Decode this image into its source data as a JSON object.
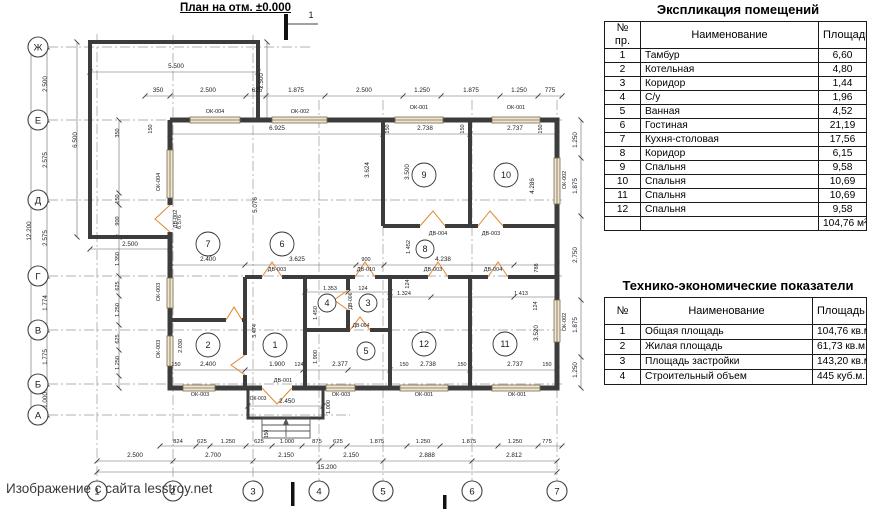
{
  "title": "План на отм. ±0.000",
  "watermark": "Изображение с сайта lesstroy.net",
  "explication": {
    "title": "Экспликация помещений",
    "headers": [
      "№ пр.",
      "Наименование",
      "Площадь"
    ],
    "rows": [
      [
        "1",
        "Тамбур",
        "6,60"
      ],
      [
        "2",
        "Котельная",
        "4,80"
      ],
      [
        "3",
        "Коридор",
        "1,44"
      ],
      [
        "4",
        "С/у",
        "1,96"
      ],
      [
        "5",
        "Ванная",
        "4,52"
      ],
      [
        "6",
        "Гостиная",
        "21,19"
      ],
      [
        "7",
        "Кухня-столовая",
        "17,56"
      ],
      [
        "8",
        "Коридор",
        "6,15"
      ],
      [
        "9",
        "Спальня",
        "9,58"
      ],
      [
        "10",
        "Спальня",
        "10,69"
      ],
      [
        "11",
        "Спальня",
        "10,69"
      ],
      [
        "12",
        "Спальня",
        "9,58"
      ]
    ],
    "total": "104,76 м²"
  },
  "tech": {
    "title": "Технико-экономические показатели",
    "headers": [
      "№",
      "Наименование",
      "Площадь"
    ],
    "rows": [
      [
        "1",
        "Общая площадь",
        "104,76 кв.м."
      ],
      [
        "2",
        "Жилая площадь",
        "61,73 кв.м."
      ],
      [
        "3",
        "Площадь застройки",
        "143,20 кв.м"
      ],
      [
        "4",
        "Строительный объем",
        "445 куб.м."
      ]
    ]
  },
  "plan": {
    "section_mark": "1",
    "axes_letters": [
      {
        "l": "Ж",
        "y": 47
      },
      {
        "l": "Е",
        "y": 120
      },
      {
        "l": "Д",
        "y": 200
      },
      {
        "l": "Г",
        "y": 276
      },
      {
        "l": "В",
        "y": 330
      },
      {
        "l": "Б",
        "y": 384
      },
      {
        "l": "А",
        "y": 415
      }
    ],
    "axes_numbers": [
      {
        "l": "1",
        "x": 97
      },
      {
        "l": "2",
        "x": 173
      },
      {
        "l": "3",
        "x": 253
      },
      {
        "l": "4",
        "x": 319
      },
      {
        "l": "5",
        "x": 383
      },
      {
        "l": "6",
        "x": 472
      },
      {
        "l": "7",
        "x": 557
      }
    ],
    "rooms": [
      {
        "n": "1",
        "x": 275,
        "y": 345,
        "r": 12
      },
      {
        "n": "2",
        "x": 208,
        "y": 345,
        "r": 12
      },
      {
        "n": "3",
        "x": 368,
        "y": 303,
        "r": 9
      },
      {
        "n": "4",
        "x": 327,
        "y": 303,
        "r": 9
      },
      {
        "n": "5",
        "x": 366,
        "y": 351,
        "r": 9
      },
      {
        "n": "6",
        "x": 282,
        "y": 244,
        "r": 12
      },
      {
        "n": "7",
        "x": 208,
        "y": 244,
        "r": 12
      },
      {
        "n": "8",
        "x": 425,
        "y": 249,
        "r": 9
      },
      {
        "n": "9",
        "x": 424,
        "y": 175,
        "r": 12
      },
      {
        "n": "10",
        "x": 506,
        "y": 175,
        "r": 12
      },
      {
        "n": "11",
        "x": 505,
        "y": 344,
        "r": 12
      },
      {
        "n": "12",
        "x": 424,
        "y": 344,
        "r": 12
      }
    ],
    "labels": [
      {
        "t": "5.500",
        "x": 176,
        "y": 68
      },
      {
        "t": "350",
        "x": 158,
        "y": 92
      },
      {
        "t": "2.500",
        "x": 208,
        "y": 92
      },
      {
        "t": "625",
        "x": 257,
        "y": 92
      },
      {
        "t": "1.875",
        "x": 296,
        "y": 92
      },
      {
        "t": "2.500",
        "x": 364,
        "y": 92
      },
      {
        "t": "1.250",
        "x": 422,
        "y": 92
      },
      {
        "t": "1.875",
        "x": 471,
        "y": 92
      },
      {
        "t": "1.250",
        "x": 519,
        "y": 92
      },
      {
        "t": "775",
        "x": 550,
        "y": 92
      },
      {
        "t": "ОК-004",
        "x": 215,
        "y": 113,
        "s": 5.5
      },
      {
        "t": "ОК-002",
        "x": 300,
        "y": 113,
        "s": 5.5
      },
      {
        "t": "ОК-001",
        "x": 419,
        "y": 109,
        "s": 5.5
      },
      {
        "t": "ОК-001",
        "x": 516,
        "y": 109,
        "s": 5.5
      },
      {
        "t": "1",
        "x": 311,
        "y": 18,
        "s": 9
      },
      {
        "t": "2.500",
        "x": 47,
        "y": 84,
        "r": -90
      },
      {
        "t": "2.575",
        "x": 47,
        "y": 160,
        "r": -90
      },
      {
        "t": "2.575",
        "x": 47,
        "y": 238,
        "r": -90
      },
      {
        "t": "1.774",
        "x": 47,
        "y": 303,
        "r": -90
      },
      {
        "t": "1.775",
        "x": 47,
        "y": 357,
        "r": -90
      },
      {
        "t": "1.000",
        "x": 47,
        "y": 400,
        "r": -90
      },
      {
        "t": "12.200",
        "x": 31,
        "y": 231,
        "r": -90
      },
      {
        "t": "6.500",
        "x": 77,
        "y": 140,
        "r": -90
      },
      {
        "t": "2.500",
        "x": 263,
        "y": 81,
        "r": -90
      },
      {
        "t": "350",
        "x": 119,
        "y": 133,
        "r": -90,
        "s": 5.5
      },
      {
        "t": "150",
        "x": 119,
        "y": 199,
        "r": -90,
        "s": 5.5
      },
      {
        "t": "900",
        "x": 119,
        "y": 221,
        "r": -90,
        "s": 5.5
      },
      {
        "t": "1.350",
        "x": 119,
        "y": 259,
        "r": -90,
        "s": 5.5
      },
      {
        "t": "625",
        "x": 119,
        "y": 286,
        "r": -90,
        "s": 5.5
      },
      {
        "t": "1.250",
        "x": 119,
        "y": 310,
        "r": -90,
        "s": 5.5
      },
      {
        "t": "625",
        "x": 119,
        "y": 339,
        "r": -90,
        "s": 5.5
      },
      {
        "t": "1.250",
        "x": 119,
        "y": 363,
        "r": -90,
        "s": 5.5
      },
      {
        "t": "2.500",
        "x": 130,
        "y": 246
      },
      {
        "t": "ОК-004",
        "x": 160,
        "y": 182,
        "r": -90,
        "s": 5.5
      },
      {
        "t": "ДВ-002",
        "x": 177,
        "y": 219,
        "r": -90,
        "s": 5.5
      },
      {
        "t": "ОК-003",
        "x": 160,
        "y": 292,
        "r": -90,
        "s": 5.5
      },
      {
        "t": "ОК-003",
        "x": 160,
        "y": 349,
        "r": -90,
        "s": 5.5
      },
      {
        "t": "6.576",
        "x": 181,
        "y": 222,
        "r": -90,
        "s": 5.5
      },
      {
        "t": "6.925",
        "x": 277,
        "y": 130
      },
      {
        "t": "150",
        "x": 152,
        "y": 129,
        "r": -90,
        "s": 5.5
      },
      {
        "t": "2.738",
        "x": 425,
        "y": 130
      },
      {
        "t": "150",
        "x": 389,
        "y": 129,
        "r": -90,
        "s": 5.5
      },
      {
        "t": "150",
        "x": 464,
        "y": 129,
        "r": -90,
        "s": 5.5
      },
      {
        "t": "2.737",
        "x": 515,
        "y": 130
      },
      {
        "t": "150",
        "x": 542,
        "y": 129,
        "r": -90,
        "s": 5.5
      },
      {
        "t": "3.624",
        "x": 369,
        "y": 170,
        "r": -90
      },
      {
        "t": "3.500",
        "x": 409,
        "y": 172,
        "r": -90
      },
      {
        "t": "4.286",
        "x": 534,
        "y": 186,
        "r": -90
      },
      {
        "t": "5.076",
        "x": 257,
        "y": 205,
        "r": -90
      },
      {
        "t": "ДВ-004",
        "x": 438,
        "y": 235,
        "s": 5.5
      },
      {
        "t": "ДВ-003",
        "x": 491,
        "y": 235,
        "s": 5.5
      },
      {
        "t": "1.452",
        "x": 410,
        "y": 247,
        "r": -90,
        "s": 5.5
      },
      {
        "t": "124",
        "x": 409,
        "y": 284,
        "r": -90,
        "s": 5.5
      },
      {
        "t": "2.400",
        "x": 208,
        "y": 261
      },
      {
        "t": "3.625",
        "x": 297,
        "y": 261
      },
      {
        "t": "900",
        "x": 366,
        "y": 261,
        "s": 5.5
      },
      {
        "t": "4.238",
        "x": 443,
        "y": 261
      },
      {
        "t": "788",
        "x": 538,
        "y": 268,
        "r": -90,
        "s": 5.5
      },
      {
        "t": "ДВ-003",
        "x": 277,
        "y": 271,
        "s": 5.5
      },
      {
        "t": "ДВ-010",
        "x": 366,
        "y": 271,
        "s": 5.5
      },
      {
        "t": "ДВ-003",
        "x": 433,
        "y": 271,
        "s": 5.5
      },
      {
        "t": "ДВ-004",
        "x": 493,
        "y": 271,
        "s": 5.5
      },
      {
        "t": "1.353",
        "x": 330,
        "y": 290,
        "s": 5.5
      },
      {
        "t": "124",
        "x": 363,
        "y": 290,
        "s": 5.5
      },
      {
        "t": "1.324",
        "x": 404,
        "y": 295,
        "s": 5.5
      },
      {
        "t": "1.413",
        "x": 521,
        "y": 295,
        "s": 5.5
      },
      {
        "t": "ДВ-006",
        "x": 352,
        "y": 301,
        "r": -90,
        "s": 5
      },
      {
        "t": "1.450",
        "x": 317,
        "y": 313,
        "r": -90,
        "s": 5.5
      },
      {
        "t": "124",
        "x": 537,
        "y": 306,
        "r": -90,
        "s": 5.5
      },
      {
        "t": "3.520",
        "x": 538,
        "y": 333,
        "r": -90
      },
      {
        "t": "ДВ-004",
        "x": 361,
        "y": 327,
        "s": 5
      },
      {
        "t": "1.900",
        "x": 317,
        "y": 357,
        "r": -90,
        "s": 5.5
      },
      {
        "t": "2.030",
        "x": 182,
        "y": 346,
        "r": -90,
        "s": 5.5
      },
      {
        "t": "3.474",
        "x": 256,
        "y": 331,
        "r": -90,
        "s": 5.5
      },
      {
        "t": "150",
        "x": 176,
        "y": 366,
        "s": 5.5
      },
      {
        "t": "2.400",
        "x": 208,
        "y": 366
      },
      {
        "t": "1.900",
        "x": 277,
        "y": 366
      },
      {
        "t": "124",
        "x": 299,
        "y": 366,
        "s": 5.5
      },
      {
        "t": "2.377",
        "x": 340,
        "y": 366
      },
      {
        "t": "150",
        "x": 404,
        "y": 366,
        "s": 5.5
      },
      {
        "t": "2.738",
        "x": 428,
        "y": 366
      },
      {
        "t": "150",
        "x": 462,
        "y": 366,
        "s": 5.5
      },
      {
        "t": "2.737",
        "x": 515,
        "y": 366
      },
      {
        "t": "150",
        "x": 547,
        "y": 366,
        "s": 5.5
      },
      {
        "t": "ОК-003",
        "x": 200,
        "y": 396,
        "s": 5.5
      },
      {
        "t": "ОК-003",
        "x": 341,
        "y": 396,
        "s": 5.5
      },
      {
        "t": "ОК-001",
        "x": 424,
        "y": 396,
        "s": 5.5
      },
      {
        "t": "ОК-001",
        "x": 517,
        "y": 396,
        "s": 5.5
      },
      {
        "t": "ДВ-001",
        "x": 283,
        "y": 382,
        "s": 5.5
      },
      {
        "t": "ОК-003",
        "x": 258,
        "y": 400,
        "s": 5
      },
      {
        "t": "2.450",
        "x": 287,
        "y": 403
      },
      {
        "t": "1.000",
        "x": 330,
        "y": 407,
        "r": -90,
        "s": 5.5
      },
      {
        "t": "150",
        "x": 268,
        "y": 434,
        "r": -90,
        "s": 5
      },
      {
        "t": "824",
        "x": 178,
        "y": 443,
        "s": 5.8
      },
      {
        "t": "625",
        "x": 202,
        "y": 443,
        "s": 5.8
      },
      {
        "t": "1.250",
        "x": 228,
        "y": 443,
        "s": 5.8
      },
      {
        "t": "625",
        "x": 259,
        "y": 443,
        "s": 5.8
      },
      {
        "t": "1.000",
        "x": 287,
        "y": 443,
        "s": 5.8
      },
      {
        "t": "875",
        "x": 317,
        "y": 443,
        "s": 5.8
      },
      {
        "t": "625",
        "x": 338,
        "y": 443,
        "s": 5.8
      },
      {
        "t": "1.875",
        "x": 377,
        "y": 443,
        "s": 5.8
      },
      {
        "t": "1.250",
        "x": 423,
        "y": 443,
        "s": 5.8
      },
      {
        "t": "1.875",
        "x": 469,
        "y": 443,
        "s": 5.8
      },
      {
        "t": "1.250",
        "x": 515,
        "y": 443,
        "s": 5.8
      },
      {
        "t": "775",
        "x": 547,
        "y": 443,
        "s": 5.8
      },
      {
        "t": "2.500",
        "x": 135,
        "y": 457
      },
      {
        "t": "2.700",
        "x": 213,
        "y": 457
      },
      {
        "t": "2.150",
        "x": 286,
        "y": 457
      },
      {
        "t": "2.150",
        "x": 351,
        "y": 457
      },
      {
        "t": "2.888",
        "x": 427,
        "y": 457
      },
      {
        "t": "2.812",
        "x": 514,
        "y": 457
      },
      {
        "t": "15.200",
        "x": 327,
        "y": 469
      },
      {
        "t": "1.250",
        "x": 577,
        "y": 140,
        "r": -90
      },
      {
        "t": "1.875",
        "x": 577,
        "y": 186,
        "r": -90
      },
      {
        "t": "2.750",
        "x": 577,
        "y": 255,
        "r": -90
      },
      {
        "t": "1.875",
        "x": 577,
        "y": 325,
        "r": -90
      },
      {
        "t": "1.250",
        "x": 577,
        "y": 370,
        "r": -90
      },
      {
        "t": "ОК-002",
        "x": 566,
        "y": 180,
        "r": -90,
        "s": 5.5
      },
      {
        "t": "ОК-002",
        "x": 566,
        "y": 322,
        "r": -90,
        "s": 5.5
      }
    ],
    "chains": [
      {
        "o": "h",
        "p": 96,
        "a": 145,
        "b": 562,
        "t": [
          145,
          170,
          246,
          266,
          325,
          403,
          441,
          500,
          538,
          562
        ]
      },
      {
        "o": "h",
        "p": 72,
        "a": 90,
        "b": 258,
        "t": [
          90,
          258
        ]
      },
      {
        "o": "v",
        "p": 47,
        "a": 47,
        "b": 415,
        "t": [
          47,
          120,
          200,
          276,
          330,
          384,
          415
        ]
      },
      {
        "o": "v",
        "p": 31,
        "a": 47,
        "b": 415,
        "t": [
          47,
          415
        ]
      },
      {
        "o": "v",
        "p": 119,
        "a": 120,
        "b": 388,
        "t": [
          120,
          193,
          205,
          237,
          276,
          296,
          325,
          350,
          376,
          388
        ]
      },
      {
        "o": "v",
        "p": 77,
        "a": 42,
        "b": 237,
        "t": [
          42,
          237
        ]
      },
      {
        "o": "v",
        "p": 267,
        "a": 42,
        "b": 120,
        "t": [
          42,
          120
        ]
      },
      {
        "o": "h",
        "p": 249,
        "a": 90,
        "b": 170,
        "t": [
          90,
          170
        ]
      },
      {
        "o": "h",
        "p": 446,
        "a": 160,
        "b": 562,
        "t": [
          160,
          196,
          210,
          246,
          272,
          302,
          332,
          347,
          407,
          440,
          498,
          538,
          562
        ]
      },
      {
        "o": "h",
        "p": 461,
        "a": 97,
        "b": 557,
        "t": [
          97,
          173,
          253,
          319,
          383,
          472,
          557
        ]
      },
      {
        "o": "h",
        "p": 472,
        "a": 97,
        "b": 557,
        "t": [
          97,
          557
        ]
      },
      {
        "o": "v",
        "p": 581,
        "a": 120,
        "b": 388,
        "t": [
          120,
          158,
          216,
          300,
          357,
          388
        ]
      },
      {
        "o": "h",
        "p": 265,
        "a": 170,
        "b": 557,
        "t": [
          170,
          245,
          356,
          384,
          514,
          557
        ]
      },
      {
        "o": "h",
        "p": 370,
        "a": 170,
        "b": 557,
        "t": [
          170,
          245,
          303,
          348,
          390,
          470,
          557
        ]
      },
      {
        "o": "h",
        "p": 134,
        "a": 170,
        "b": 557,
        "t": [
          170,
          383,
          470,
          557
        ]
      },
      {
        "o": "h",
        "p": 406,
        "a": 248,
        "b": 323,
        "t": [
          248,
          323
        ]
      },
      {
        "o": "h",
        "p": 292,
        "a": 305,
        "b": 390,
        "t": [
          305,
          348,
          390
        ]
      },
      {
        "o": "h",
        "p": 297,
        "a": 390,
        "b": 557,
        "t": [
          390,
          431,
          514,
          557
        ]
      }
    ]
  }
}
